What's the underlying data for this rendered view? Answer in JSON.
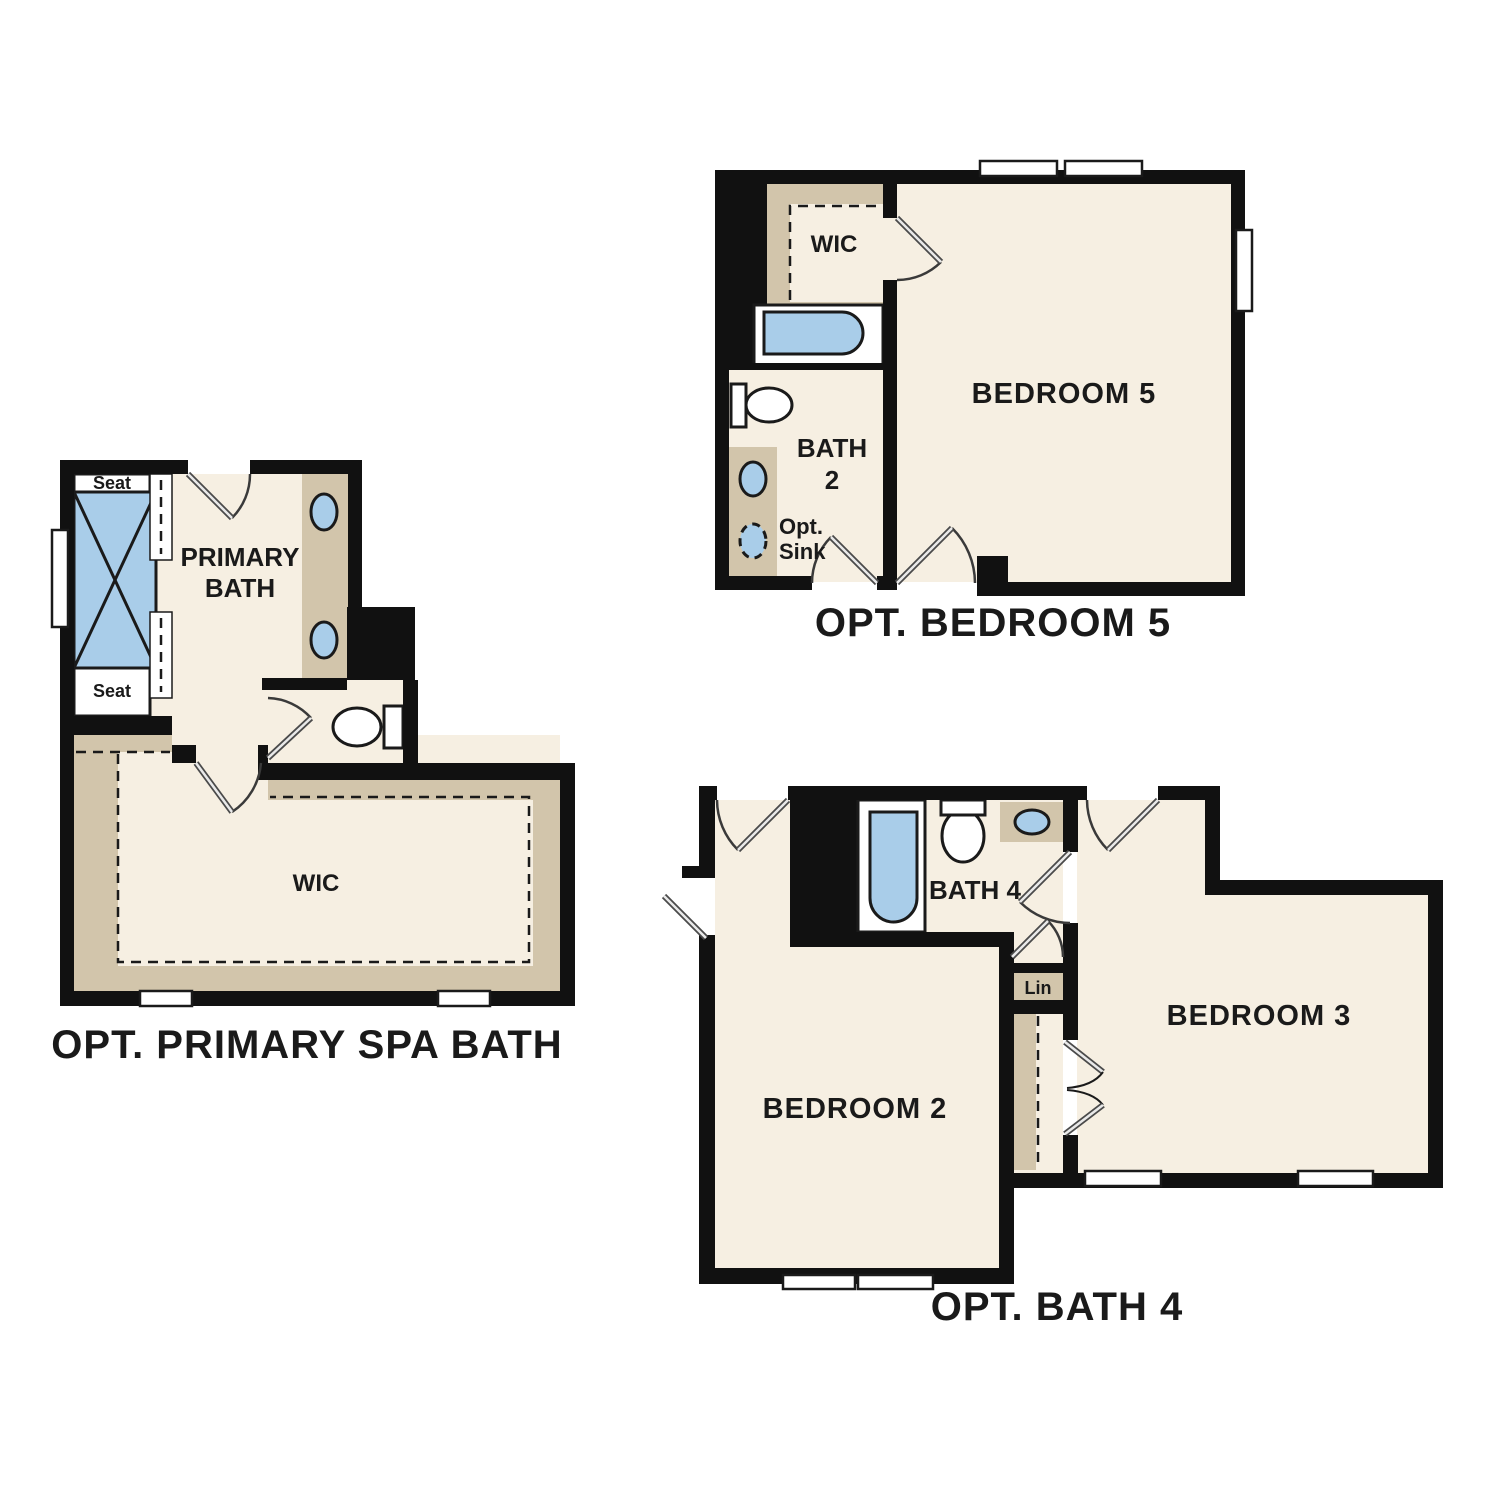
{
  "colors": {
    "background": "#ffffff",
    "wall": "#111111",
    "floor": "#f6efe2",
    "shelf_tan": "#d2c5ab",
    "fixture_blue": "#a9cde9",
    "line": "#1a1a1a",
    "text": "#1a1a1a"
  },
  "plans": {
    "bedroom5": {
      "title": "OPT. BEDROOM 5",
      "labels": {
        "bedroom": "BEDROOM 5",
        "wic": "WIC",
        "bath_line1": "BATH",
        "bath_line2": "2",
        "opt_sink_line1": "Opt.",
        "opt_sink_line2": "Sink"
      }
    },
    "primary_spa_bath": {
      "title": "OPT. PRIMARY SPA BATH",
      "labels": {
        "room_line1": "PRIMARY",
        "room_line2": "BATH",
        "wic": "WIC",
        "seat_top": "Seat",
        "seat_bottom": "Seat"
      }
    },
    "bath4": {
      "title": "OPT. BATH 4",
      "labels": {
        "bedroom2": "BEDROOM 2",
        "bedroom3": "BEDROOM 3",
        "bath": "BATH 4",
        "linen": "Lin"
      }
    }
  }
}
